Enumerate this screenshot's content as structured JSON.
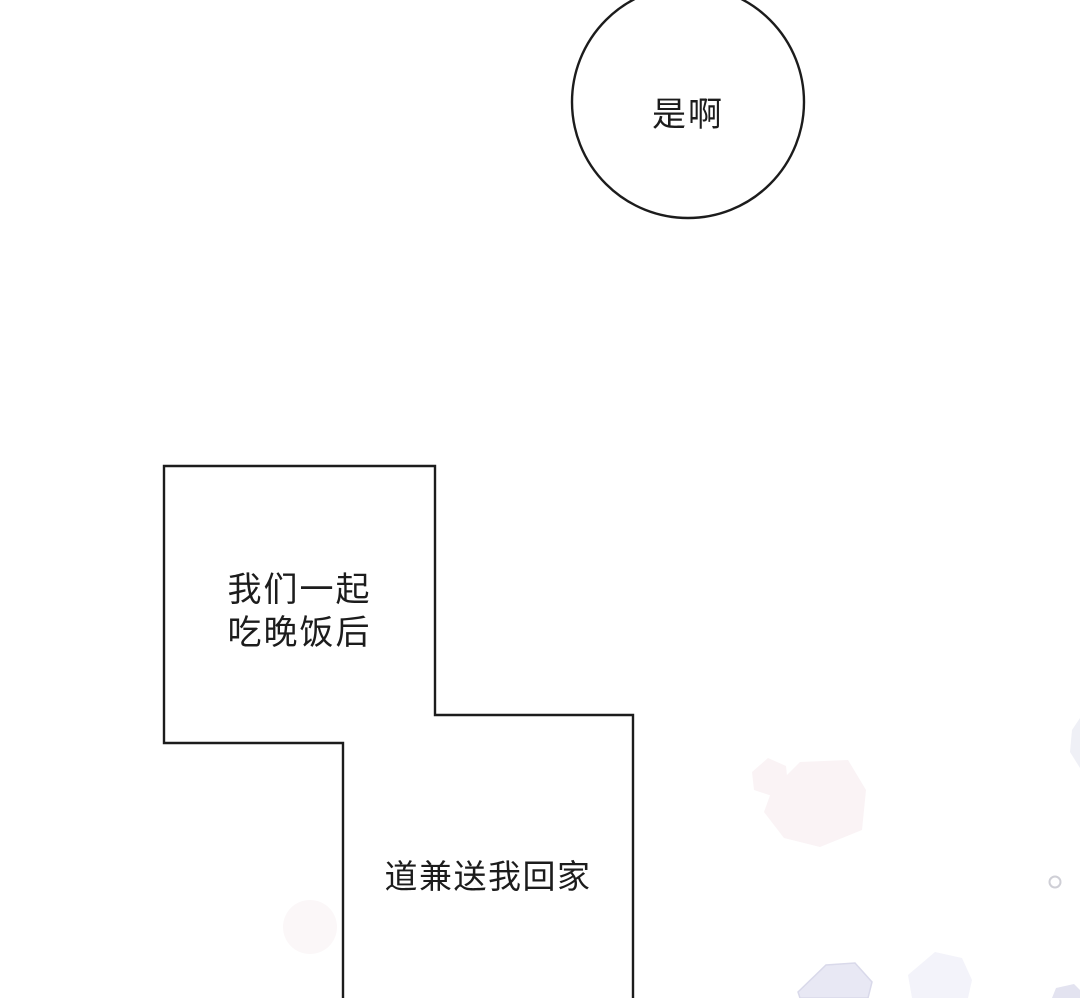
{
  "page": {
    "kind": "comic-panel",
    "background": "#ffffff"
  },
  "colors": {
    "paper": "#ffffff",
    "ink": "#1c1c1c",
    "blush-pink": "#faf3f5",
    "blush-pink-faint": "#fbf7f8",
    "sparkle-lavender": "#e8e8f4",
    "sparkle-lavender-faint": "#f3f3fa",
    "sparkle-lavender-edge": "#d9d9ea",
    "sparkle-gray": "#cfcfd6"
  },
  "bubbles": [
    {
      "name": "circle-bubble",
      "shape": "circle",
      "text": "是啊"
    },
    {
      "name": "upper-stepped-bubble",
      "shape": "stepped-rectangle",
      "lines": [
        "我们一起",
        "吃晚饭后"
      ]
    },
    {
      "name": "lower-stepped-bubble",
      "shape": "stepped-rectangle",
      "text": "道兼送我回家"
    }
  ]
}
